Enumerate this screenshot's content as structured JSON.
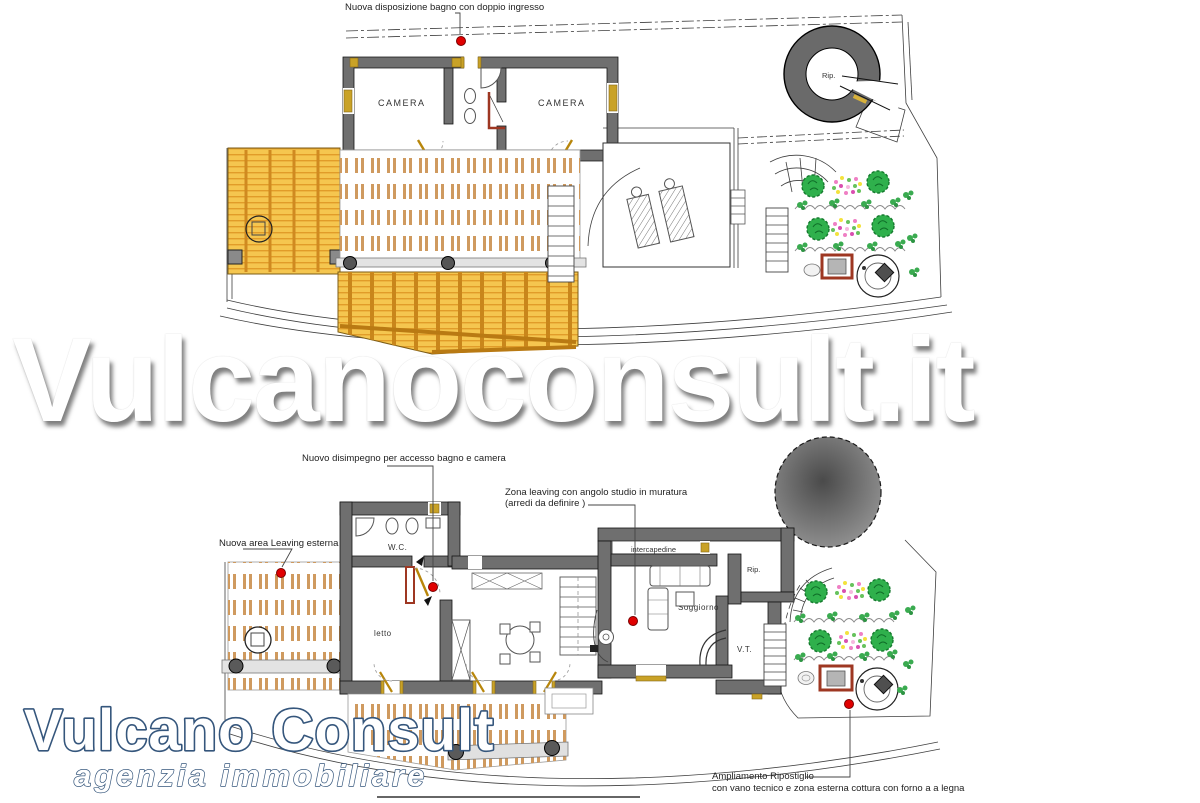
{
  "watermark": "Vulcanoconsult.it",
  "logo": {
    "title": "Vulcano Consult",
    "subtitle": "agenzia  immobiliare"
  },
  "upper_plan": {
    "annotation_bathroom": "Nuova disposizione bagno con doppio ingresso",
    "rooms": {
      "camera_left": "CAMERA",
      "camera_right": "CAMERA",
      "rip": "Rip."
    }
  },
  "lower_plan": {
    "annotation_disimpegno": "Nuovo disimpegno per accesso bagno e camera",
    "annotation_zona_line1": "Zona leaving con angolo studio in muratura",
    "annotation_zona_line2": "(arredi da definire )",
    "annotation_area_esterna": "Nuova area Leaving esterna",
    "annotation_ampliamento_line1": "Ampliamento Ripostiglio",
    "annotation_ampliamento_line2": "con vano tecnico e zona esterna cottura con forno a a legna",
    "rooms": {
      "wc": "W.C.",
      "letto": "letto",
      "soggiorno": "Soggiorno",
      "intercapedine": "intercapedine",
      "rip": "Rip.",
      "vt": "V.T."
    }
  },
  "colors": {
    "wall": "#6f6f6f",
    "pergola": "#f5c64f",
    "deck_strip": "#cf9a5f",
    "tree": "#2fb04c",
    "brick": "#9e3722",
    "marker": "#e00000",
    "logo_outline": "#35567c"
  }
}
